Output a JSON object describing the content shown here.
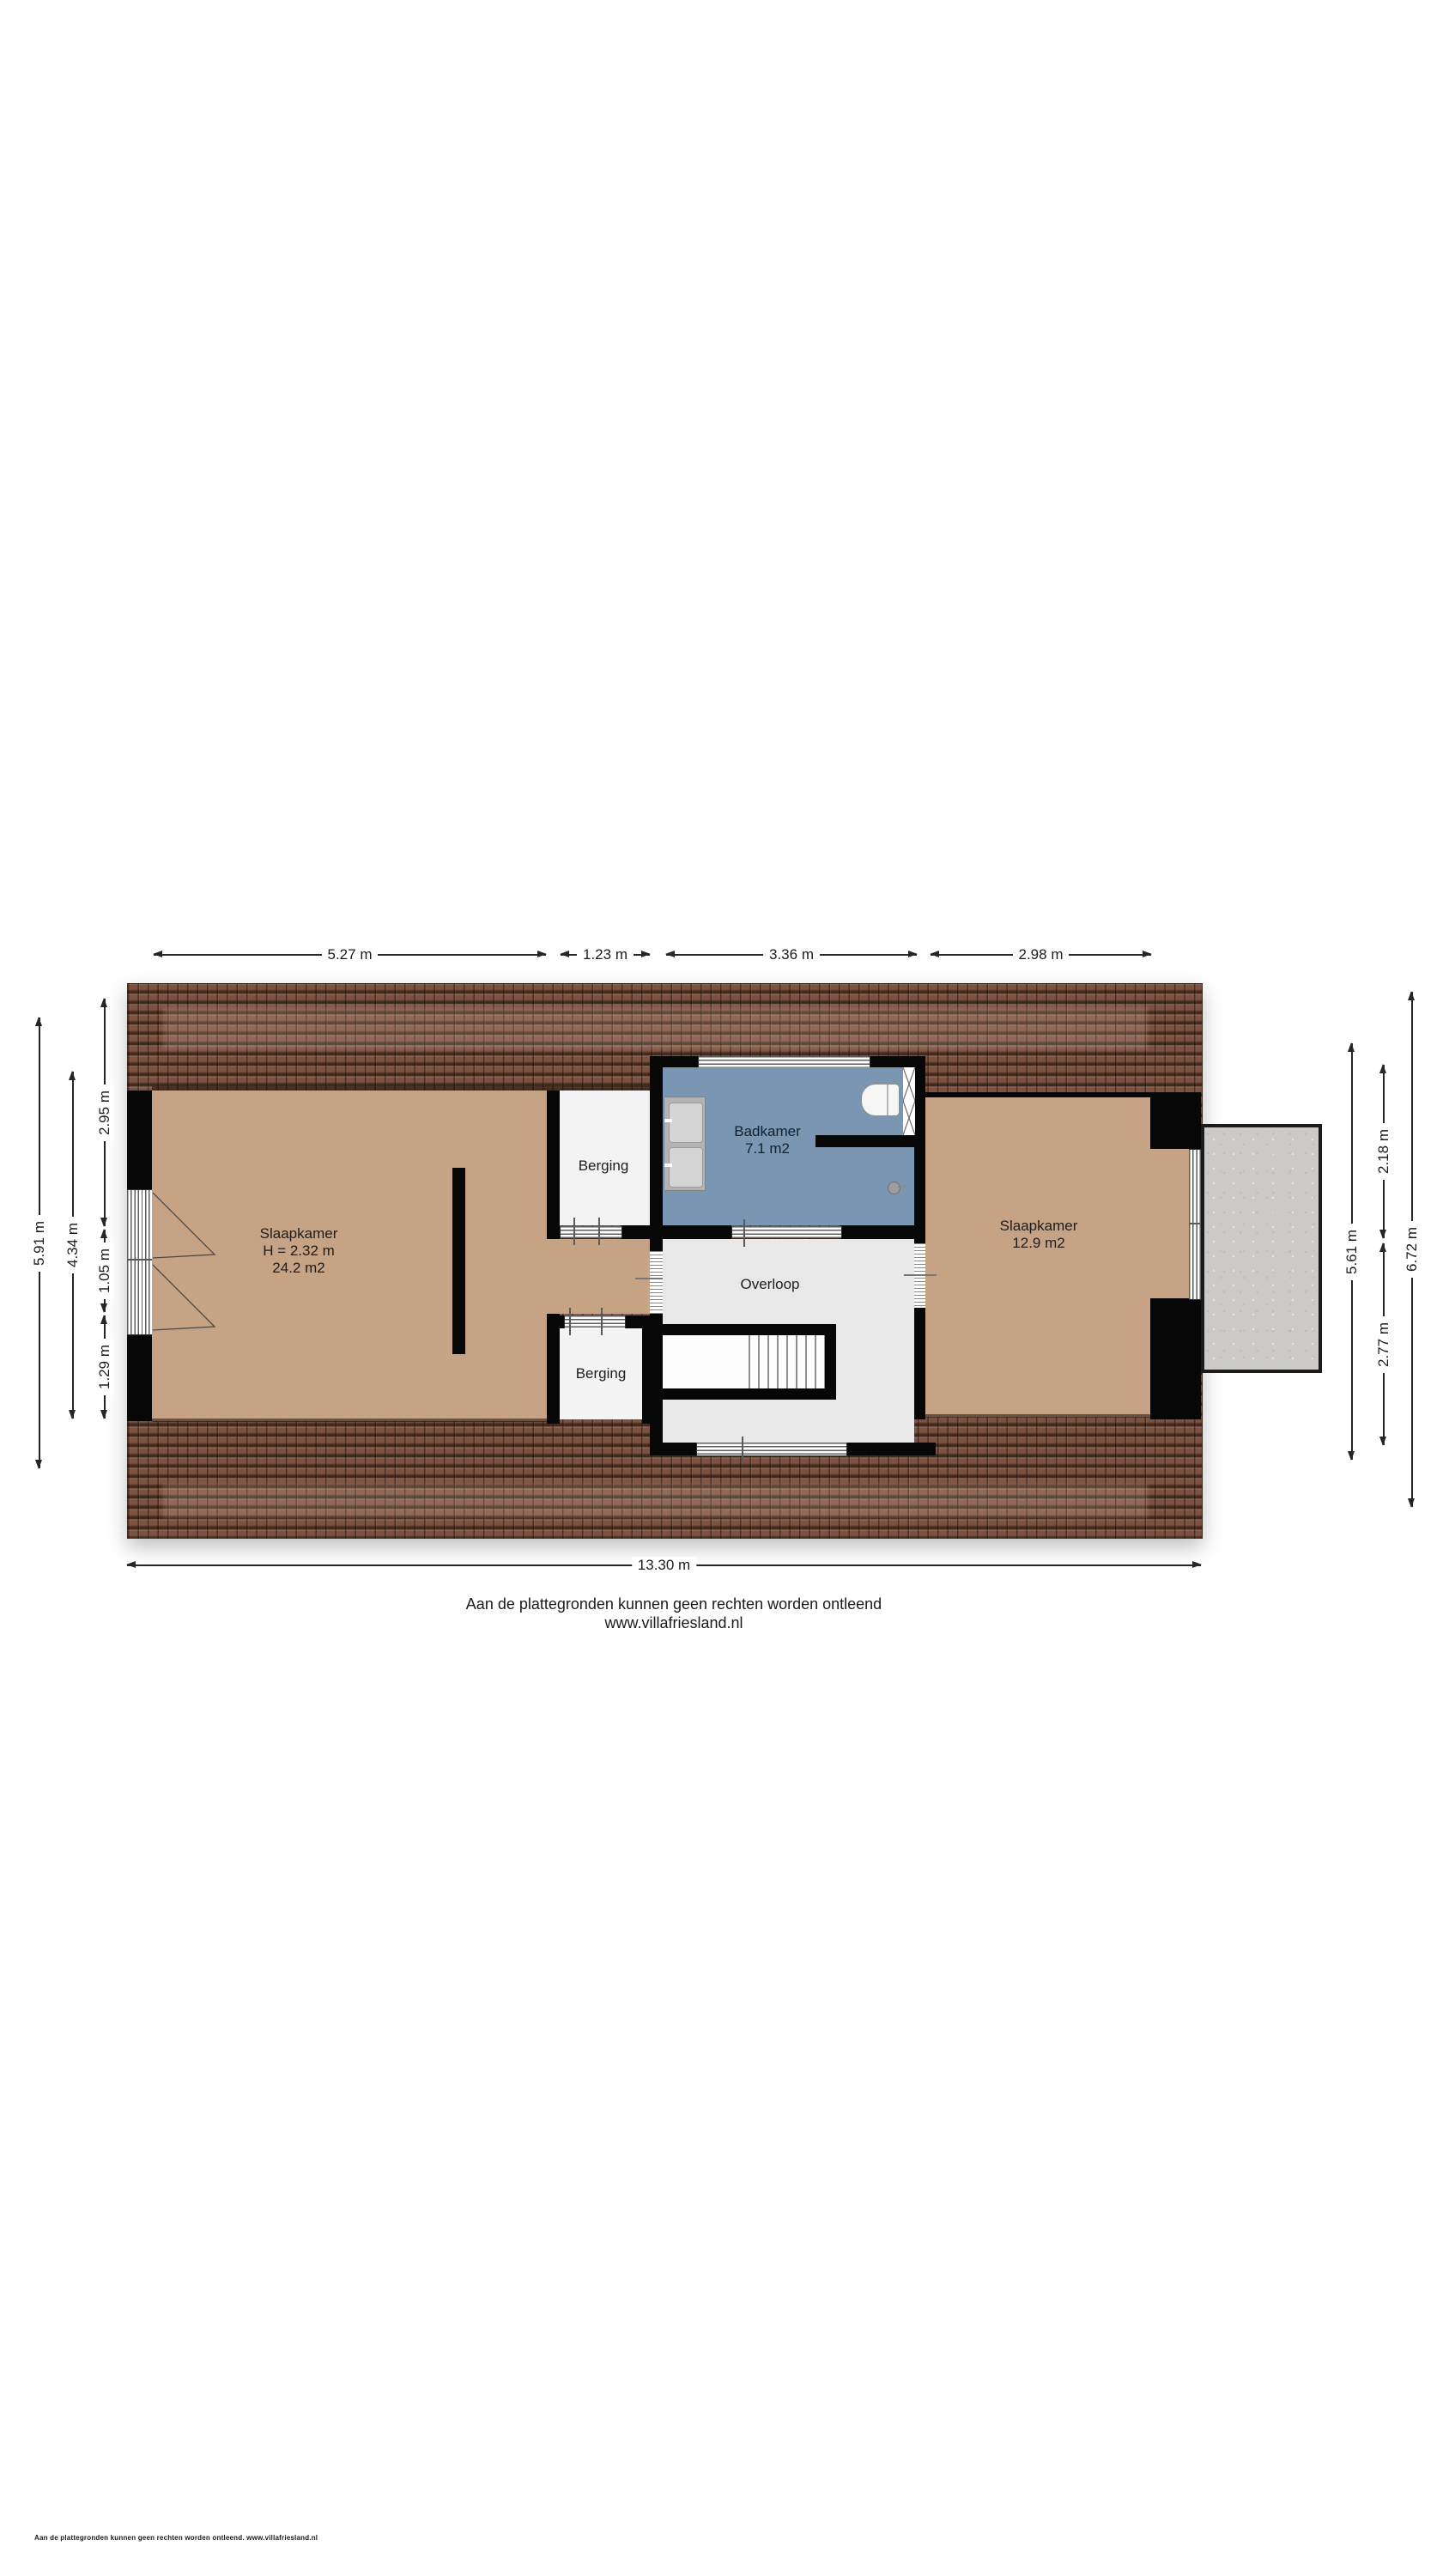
{
  "plan": {
    "rooms": {
      "slaapkamer_left": {
        "name": "Slaapkamer",
        "height": "H = 2.32 m",
        "area": "24.2  m2"
      },
      "berging_top": {
        "name": "Berging"
      },
      "badkamer": {
        "name": "Badkamer",
        "area": "7.1 m2"
      },
      "slaapkamer_right": {
        "name": "Slaapkamer",
        "area": "12.9 m2"
      },
      "overloop": {
        "name": "Overloop"
      },
      "berging_bottom": {
        "name": "Berging"
      }
    },
    "dims": {
      "top1": "5.27 m",
      "top2": "1.23 m",
      "top3": "3.36 m",
      "top4": "2.98 m",
      "left_total": "5.91 m",
      "left_inner": "4.34 m",
      "left_a": "2.95 m",
      "left_b": "1.05 m",
      "left_c": "1.29 m",
      "right_inner": "5.61 m",
      "right_a": "2.18 m",
      "right_b": "2.77 m",
      "right_total": "6.72 m",
      "bottom_total": "13.30 m"
    },
    "footer": {
      "disclaimer": "Aan de plattegronden kunnen geen rechten worden ontleend",
      "website": "www.villafriesland.nl",
      "fine_print": "Aan de plattegronden kunnen geen rechten worden ontleend. www.villafriesland.nl"
    },
    "colors": {
      "roof": "#7b523f",
      "bedroom_floor": "#c5a384",
      "bathroom_floor": "#7b96b3",
      "storage_floor": "#f3f3f3",
      "landing_floor": "#e8e8e8",
      "wall": "#070707",
      "balcony": "#cbcac7"
    }
  }
}
